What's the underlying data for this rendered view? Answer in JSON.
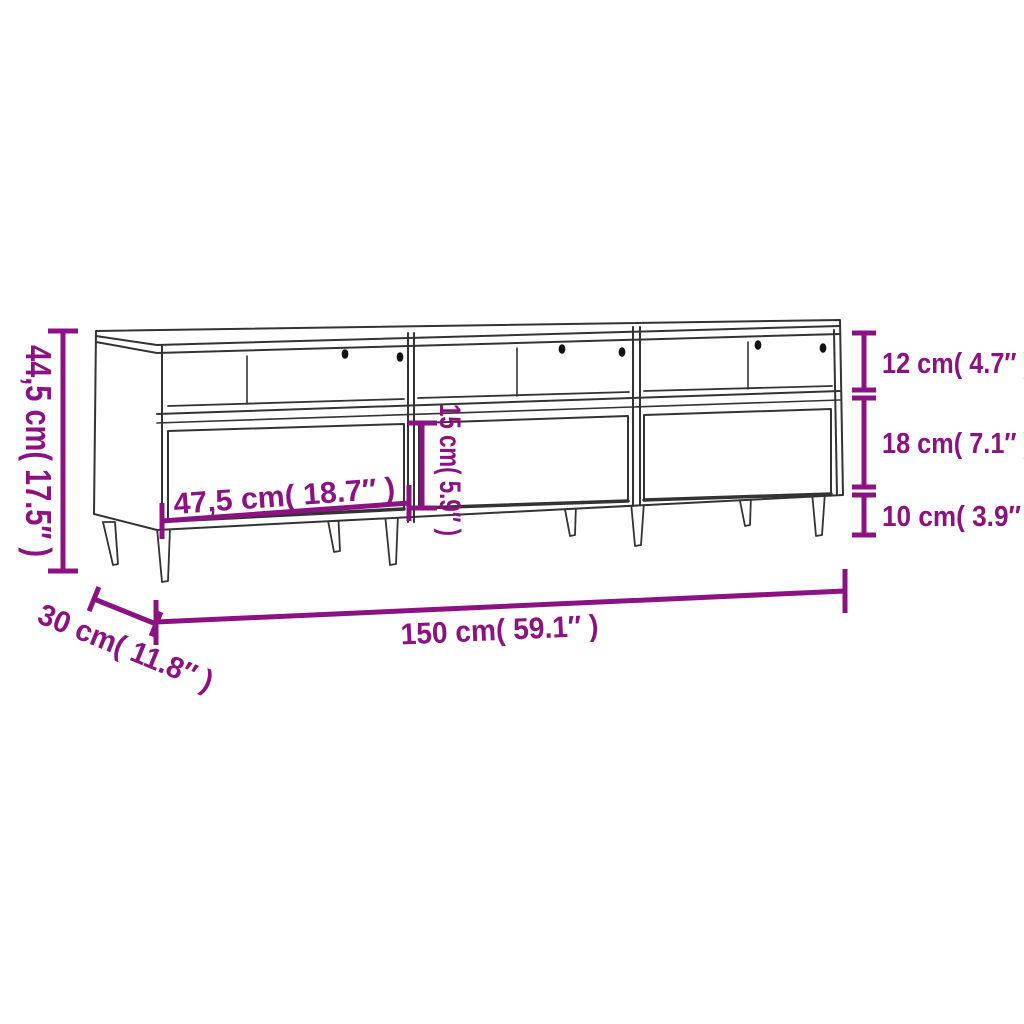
{
  "diagram": {
    "type": "product-dimension-diagram",
    "product": "TV cabinet with 3 open shelves, 3 drawers, cable holes and tapered metal legs",
    "accent_color": "#8C1183",
    "line_color": "#333333",
    "background": "#ffffff",
    "dimensions": {
      "overall_height": "44,5 cm( 17.5″ )",
      "shelf_opening_height": "12 cm( 4.7″ )",
      "drawer_zone_height": "18 cm( 7.1″ )",
      "leg_height": "10 cm( 3.9″ )",
      "drawer_front_height": "15 cm( 5.9″ )",
      "drawer_width": "47,5 cm( 18.7″ )",
      "overall_width": "150 cm( 59.1″ )",
      "overall_depth": "30 cm( 11.8″ )"
    }
  }
}
